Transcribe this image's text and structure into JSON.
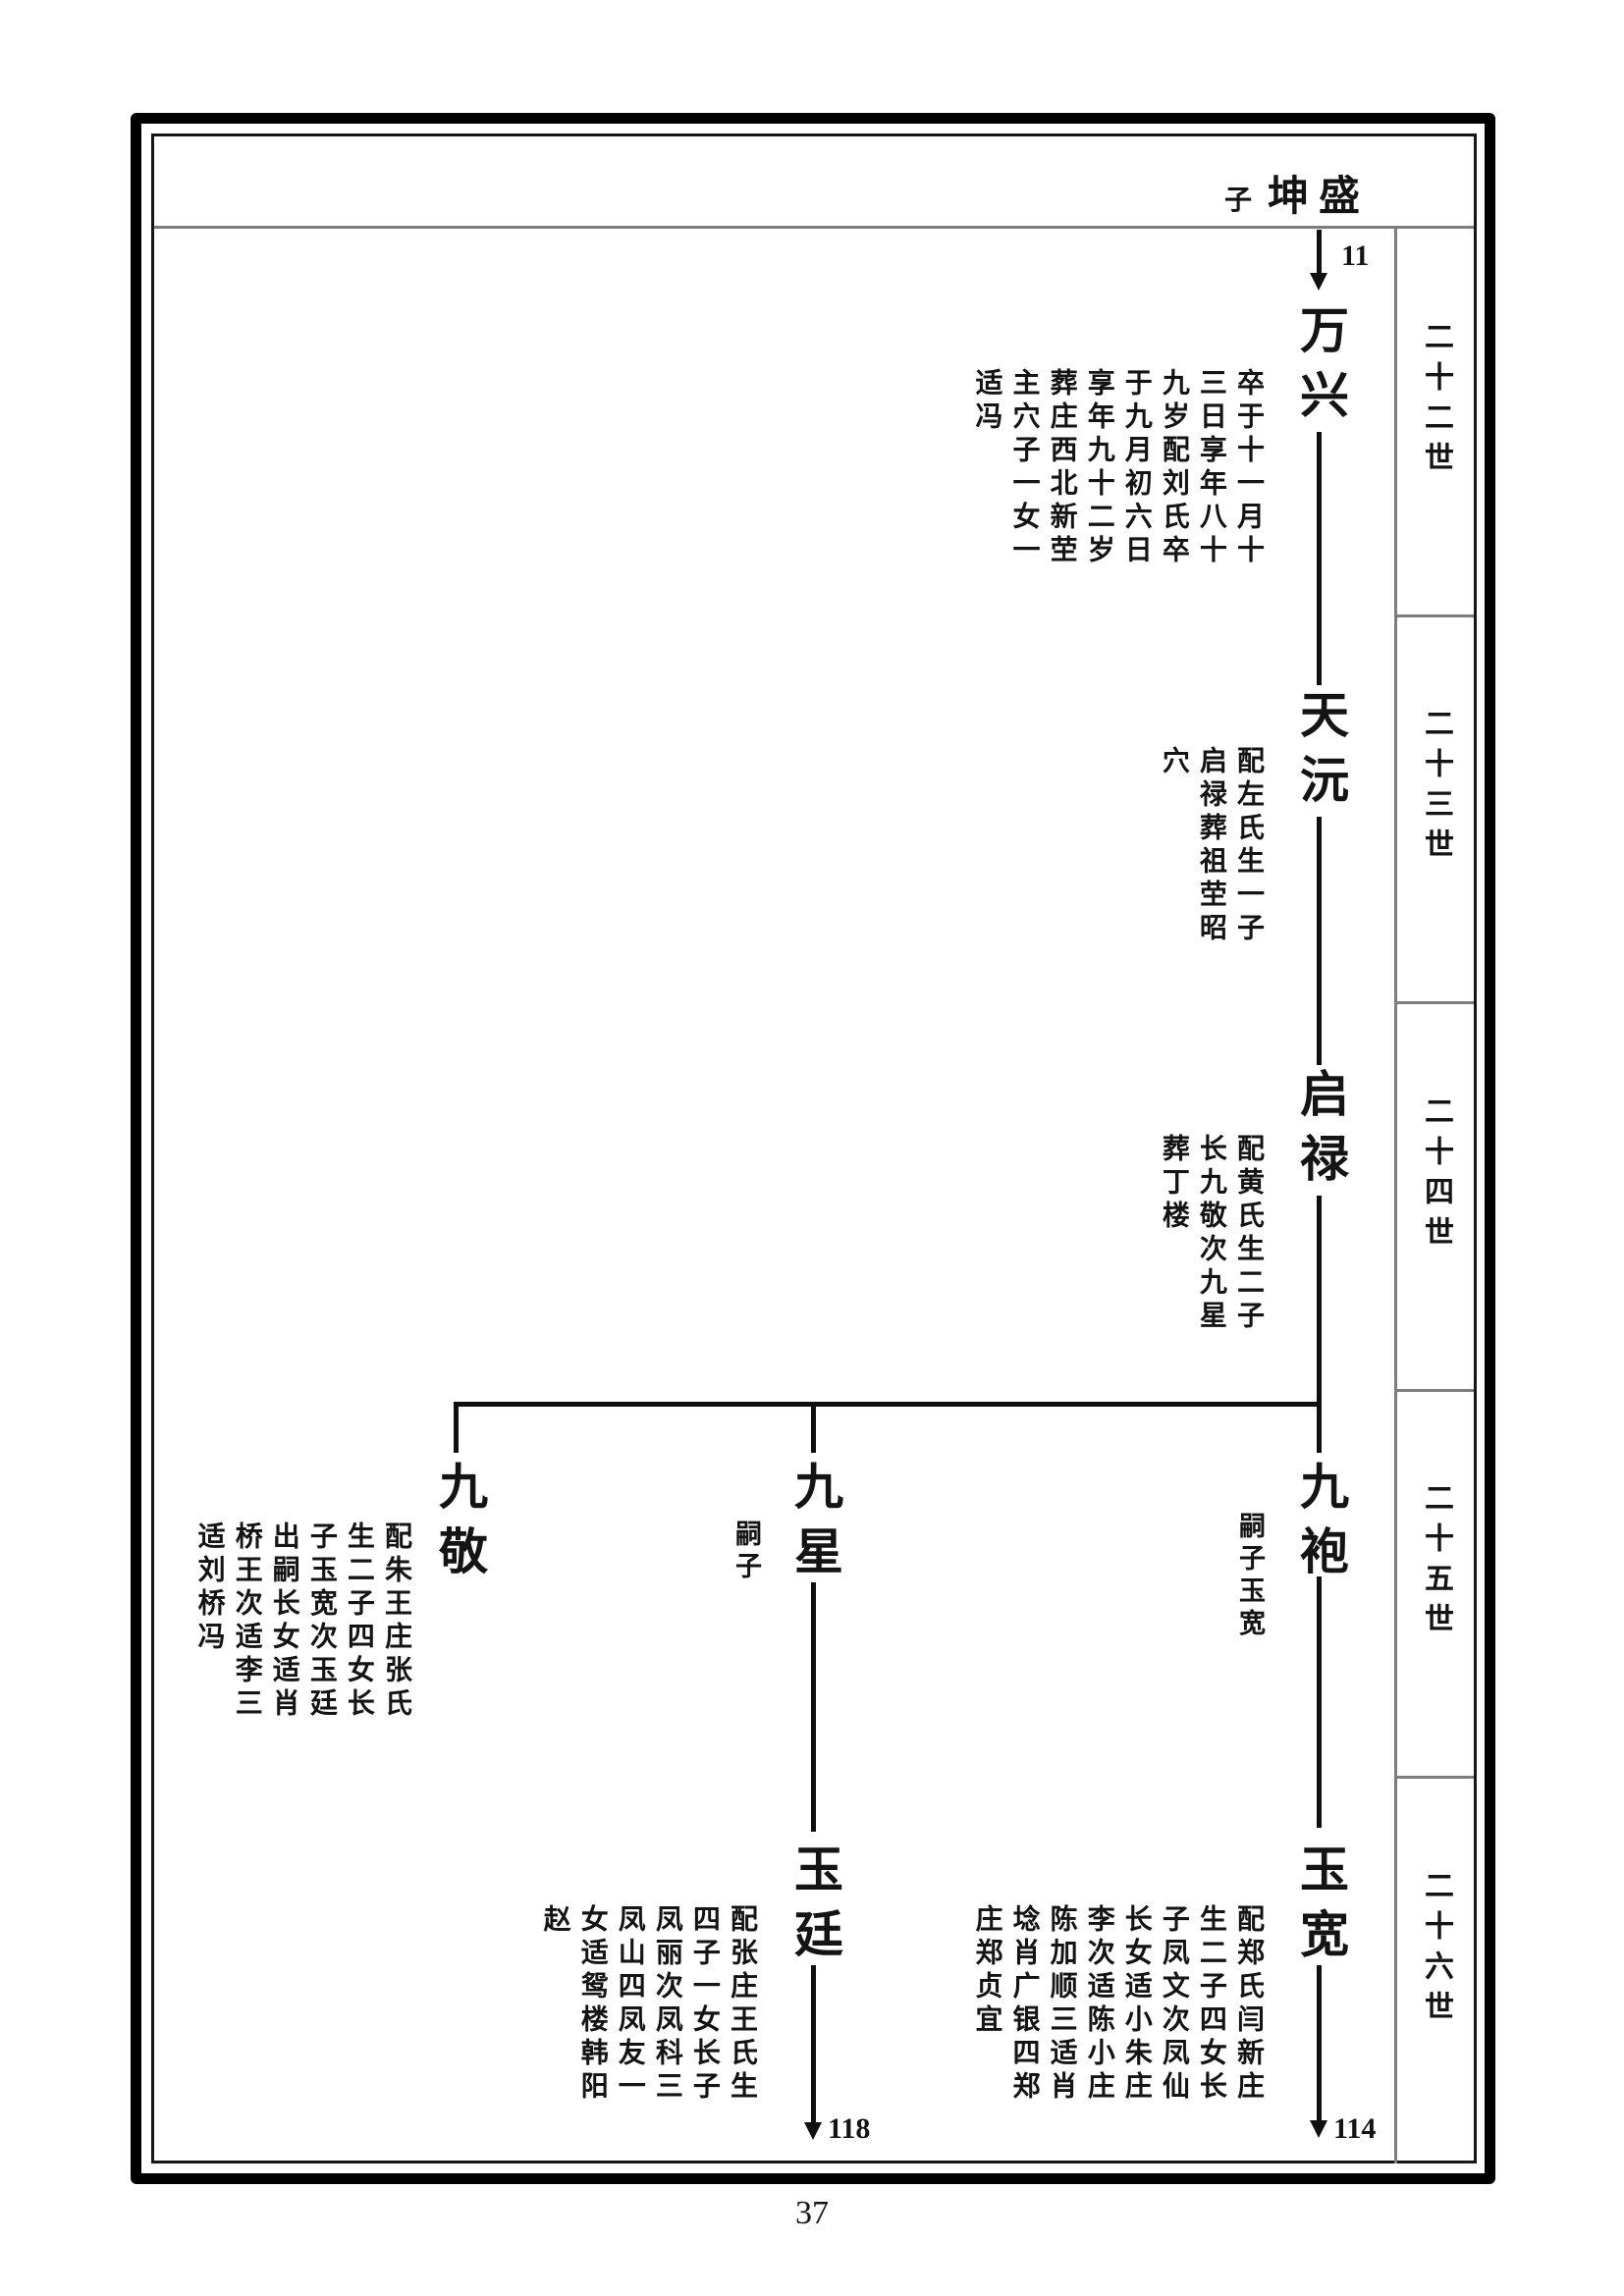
{
  "header": {
    "son_label": "子",
    "name": "坤盛"
  },
  "sidebar": {
    "generations": [
      "二十二世",
      "二十三世",
      "二十四世",
      "二十五世",
      "二十六世"
    ]
  },
  "tree": {
    "root_arrow_label": "11",
    "wanxing": {
      "name": "万兴",
      "detail": "卒于十一月十三日享年八十九岁配刘氏卒于九月初六日享年九十二岁葬庄西北新茔主穴子一女一适冯"
    },
    "tianyuan": {
      "name": "天沅",
      "detail": "配左氏生一子启禄葬祖茔昭穴"
    },
    "qilu": {
      "name": "启禄",
      "detail": "配黄氏生二子长九敬次九星葬丁楼"
    },
    "jiujing": {
      "name": "九敬",
      "detail": "配朱王庄张氏生二子四女长子玉宽次玉廷出嗣长女适肖桥王次适李三适刘桥冯"
    },
    "jiuxing": {
      "name": "九星",
      "side_label": "嗣子"
    },
    "jiupao": {
      "name": "九袍",
      "side_label": "嗣子玉宽"
    },
    "yuting": {
      "name": "玉廷",
      "detail": "配张庄王氏生四子一女长子凤丽次凤科三凤山四凤友一女适鸳楼韩阳赵",
      "arrow_label": "118"
    },
    "yukuan": {
      "name": "玉宽",
      "detail": "配郑氏闫新庄生二子四女长子凤文次凤仙长女适小朱庄李次适陈小庄陈加顺三适肖埝肖广银四郑庄郑贞宜",
      "arrow_label": "114"
    }
  },
  "footer": {
    "page_number": "37"
  }
}
